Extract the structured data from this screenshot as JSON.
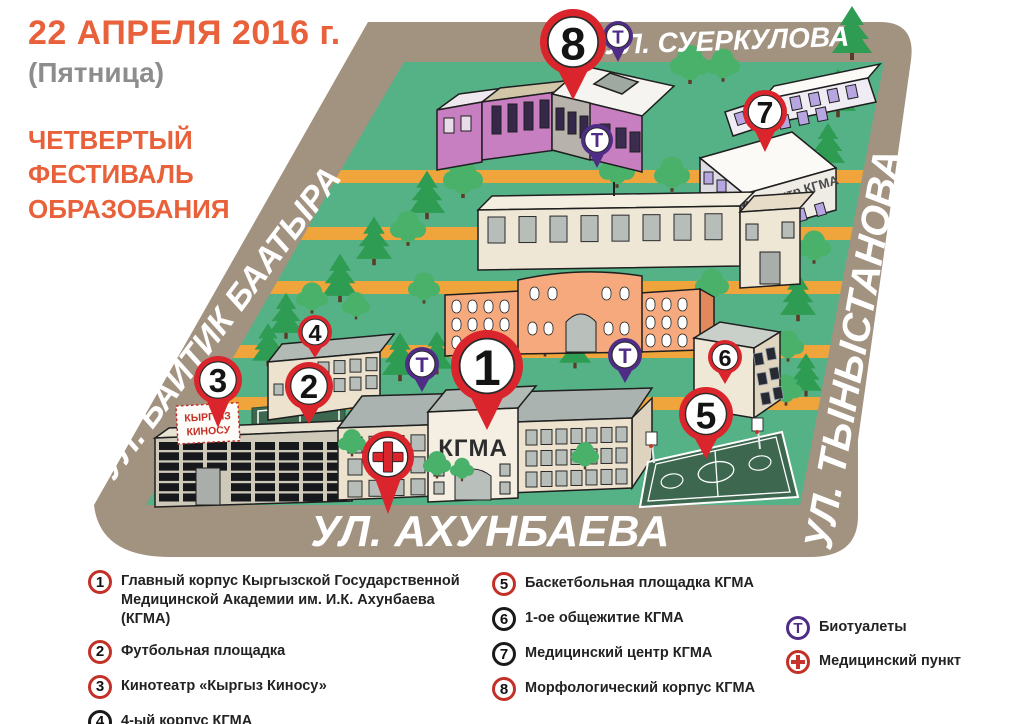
{
  "title": {
    "date_line": "22 АПРЕЛЯ 2016 г.",
    "weekday_line": "(Пятница)",
    "event_lines": [
      "ЧЕТВЕРТЫЙ",
      "ФЕСТИВАЛЬ",
      "ОБРАЗОБАНИЯ"
    ]
  },
  "streets": {
    "top": "УЛ. СУЕРКУЛОВА",
    "left": "УЛ. БАЙТИК БААТЫРА",
    "right": "УЛ. ТЫНЫСТАНОВА",
    "bottom": "УЛ. АХУНБАЕВА"
  },
  "map": {
    "main_building_label": "КГМА",
    "medcenter_label": "Медцентр КГМА",
    "cinema_sign_lines": [
      "КЫРГЫЗ",
      "КИНОСУ"
    ]
  },
  "pins": [
    {
      "id": "1",
      "label": "1",
      "kind": "number"
    },
    {
      "id": "2",
      "label": "2",
      "kind": "number"
    },
    {
      "id": "3",
      "label": "3",
      "kind": "number"
    },
    {
      "id": "4",
      "label": "4",
      "kind": "number"
    },
    {
      "id": "5",
      "label": "5",
      "kind": "number"
    },
    {
      "id": "6",
      "label": "6",
      "kind": "number"
    },
    {
      "id": "7",
      "label": "7",
      "kind": "number"
    },
    {
      "id": "8",
      "label": "8",
      "kind": "number"
    },
    {
      "id": "t1",
      "label": "Т",
      "kind": "toilet"
    },
    {
      "id": "t2",
      "label": "Т",
      "kind": "toilet"
    },
    {
      "id": "t3",
      "label": "Т",
      "kind": "toilet"
    },
    {
      "id": "t4",
      "label": "Т",
      "kind": "toilet"
    },
    {
      "id": "cross",
      "label": "+",
      "kind": "medpoint"
    }
  ],
  "legend": {
    "items": [
      {
        "number": "1",
        "text": "Главный корпус Кыргызской Государственной Медицинской Академии им. И.К. Ахунбаева (КГМА)",
        "ring": "red"
      },
      {
        "number": "2",
        "text": "Футбольная площадка",
        "ring": "red"
      },
      {
        "number": "3",
        "text": "Кинотеатр «Кыргыз Киносу»",
        "ring": "red"
      },
      {
        "number": "4",
        "text": "4-ый корпус КГМА",
        "ring": "black"
      },
      {
        "number": "5",
        "text": "Баскетбольная площадка КГМА",
        "ring": "red"
      },
      {
        "number": "6",
        "text": "1-ое общежитие КГМА",
        "ring": "black"
      },
      {
        "number": "7",
        "text": "Медицинский центр КГМА",
        "ring": "black"
      },
      {
        "number": "8",
        "text": "Морфологический корпус КГМА",
        "ring": "red"
      }
    ],
    "toilets_symbol": "Т",
    "toilets_label": "Биотуалеты",
    "medpoint_symbol": "+",
    "medpoint_label": "Медицинский пункт"
  },
  "colors": {
    "accent_orange": "#e8613a",
    "street_brown": "#a29280",
    "grass_green": "#55b286",
    "road_yellow": "#f0a53c",
    "pin_red": "#d9252b",
    "pin_purple": "#4f2d87",
    "field_green": "#3d684f"
  }
}
